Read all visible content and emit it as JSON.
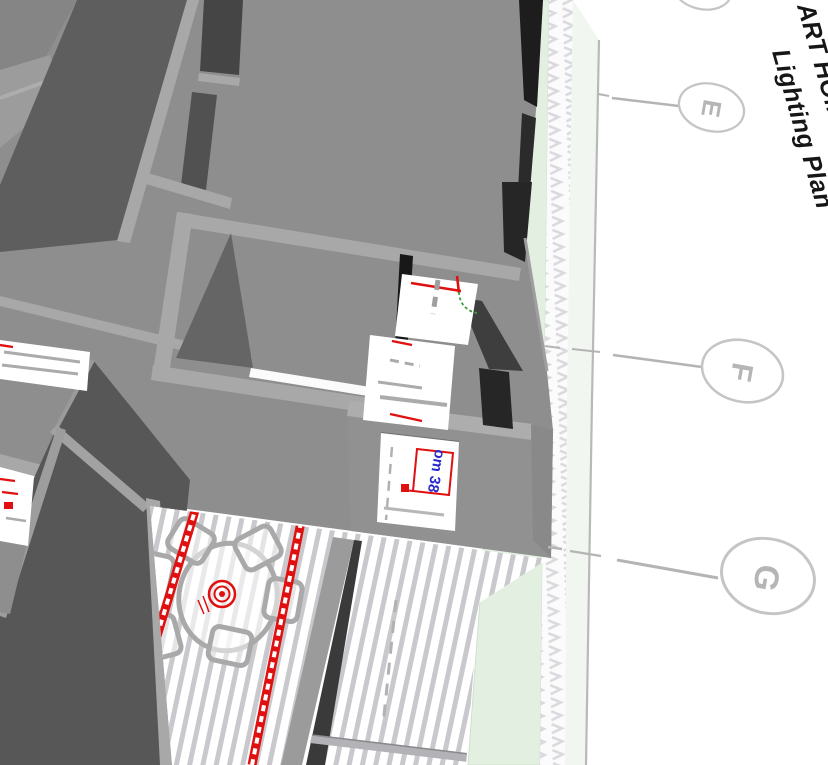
{
  "sheet": {
    "title_line1": "ART HOME",
    "title_line2": "Lighting Plan",
    "grid_bubbles": [
      {
        "label": "E"
      },
      {
        "label": "F"
      },
      {
        "label": "G"
      }
    ],
    "room_label": "om 38",
    "room_label_partial": "Lo"
  },
  "symbols": {
    "ceiling_light": "concentric-red-circles",
    "led_chain": "red-dashed-track",
    "door_swing": "gray-arc",
    "grid_bubble": "ellipse-with-letter"
  },
  "colors": {
    "wall_face": "#8e8e8e",
    "wall_cap": "#a8a8a8",
    "wall_dark": "#5c5c5c",
    "wall_deep": "#1b1b1b",
    "plan_red": "#e01010",
    "plan_blue": "#2a2acc",
    "plan_gray": "#ababab",
    "greenery": "#e3f0e1",
    "arc_green": "#3f9f3f",
    "bubble_stroke": "#c5c5c5",
    "bubble_letter": "#b5b5b5",
    "title_ink": "#161616",
    "floor_board": "#c9c9cd"
  }
}
